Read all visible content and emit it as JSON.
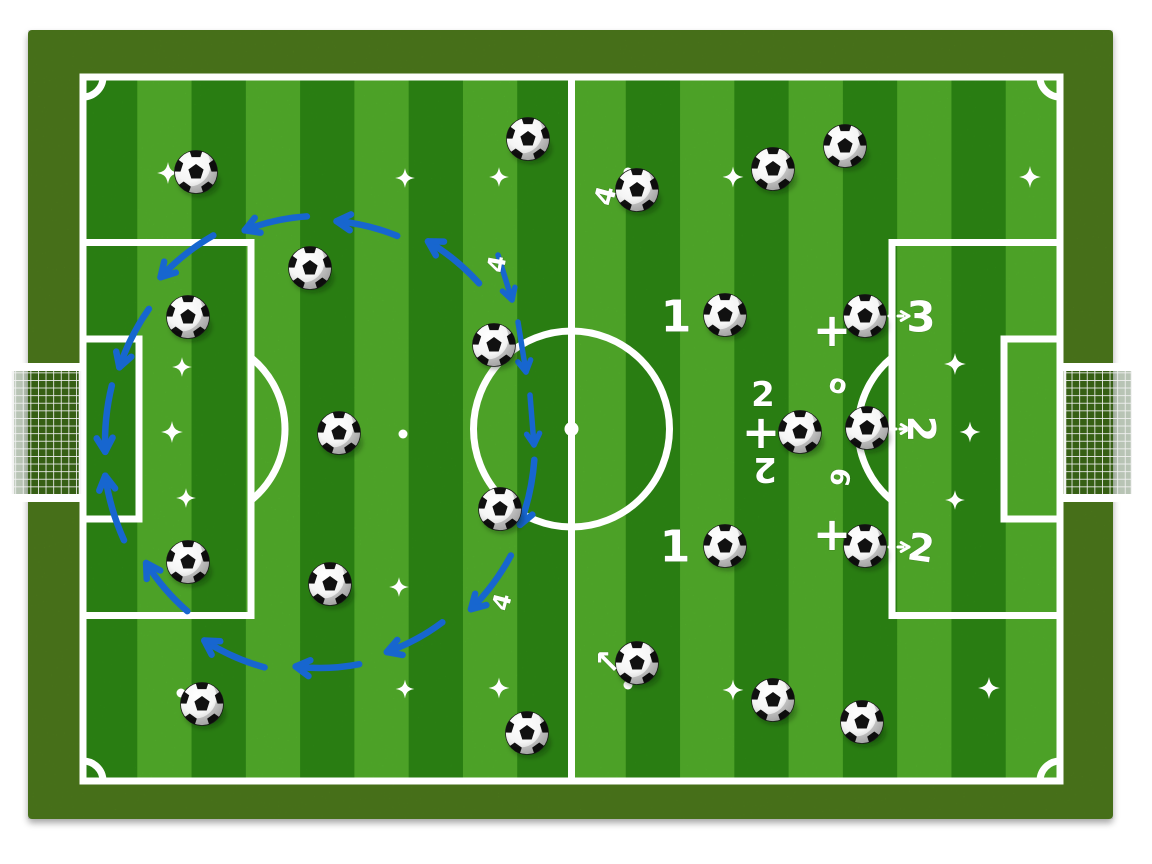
{
  "scene": {
    "description": "Soccer training drill diagram: striped football pitch viewed from above with scattered balls, white sparkle markers, hand-drawn white number annotations and a blue hand-drawn dashed circular arrow flow on the left half",
    "background_color": "#ffffff"
  },
  "field": {
    "border_color": "#507d1d",
    "stripe_dark": "#2e8c15",
    "stripe_light": "#55b52c",
    "line_color": "#ffffff",
    "line_width": 7,
    "outer": {
      "x": 28,
      "y": 30,
      "w": 1085,
      "h": 789
    },
    "pitch": {
      "x": 83,
      "y": 77,
      "w": 977,
      "h": 704
    },
    "stripe_count": 18,
    "first_stripe_dark": true,
    "center_circle_radius": 98,
    "center_dot_radius": 7,
    "penalty_box": {
      "w": 168,
      "h": 373
    },
    "goal_box": {
      "w": 56,
      "h": 180
    },
    "penalty_spot_dist": 110,
    "penalty_arc_radius": 92,
    "corner_arc_radius": 20,
    "goal": {
      "depth": 75,
      "mouth_top": 363,
      "mouth_bottom": 500
    }
  },
  "balls": [
    {
      "x": 528,
      "y": 139
    },
    {
      "x": 845,
      "y": 146
    },
    {
      "x": 773,
      "y": 169
    },
    {
      "x": 637,
      "y": 190
    },
    {
      "x": 196,
      "y": 172
    },
    {
      "x": 310,
      "y": 268
    },
    {
      "x": 188,
      "y": 317
    },
    {
      "x": 494,
      "y": 345
    },
    {
      "x": 725,
      "y": 315
    },
    {
      "x": 865,
      "y": 316
    },
    {
      "x": 339,
      "y": 433
    },
    {
      "x": 800,
      "y": 432
    },
    {
      "x": 867,
      "y": 428
    },
    {
      "x": 188,
      "y": 562
    },
    {
      "x": 330,
      "y": 584
    },
    {
      "x": 500,
      "y": 509
    },
    {
      "x": 202,
      "y": 704
    },
    {
      "x": 527,
      "y": 733
    },
    {
      "x": 725,
      "y": 546
    },
    {
      "x": 865,
      "y": 546
    },
    {
      "x": 637,
      "y": 663
    },
    {
      "x": 773,
      "y": 700
    },
    {
      "x": 862,
      "y": 722
    }
  ],
  "sparkles": [
    {
      "x": 168,
      "y": 173,
      "s": 1.0
    },
    {
      "x": 405,
      "y": 178,
      "s": 0.9
    },
    {
      "x": 499,
      "y": 177,
      "s": 0.9
    },
    {
      "x": 733,
      "y": 177,
      "s": 0.95
    },
    {
      "x": 1030,
      "y": 177,
      "s": 1.0
    },
    {
      "x": 182,
      "y": 367,
      "s": 0.9
    },
    {
      "x": 955,
      "y": 364,
      "s": 1.0
    },
    {
      "x": 172,
      "y": 432,
      "s": 1.0
    },
    {
      "x": 970,
      "y": 432,
      "s": 0.95
    },
    {
      "x": 186,
      "y": 498,
      "s": 0.9
    },
    {
      "x": 955,
      "y": 500,
      "s": 0.9
    },
    {
      "x": 399,
      "y": 587,
      "s": 0.9
    },
    {
      "x": 405,
      "y": 689,
      "s": 0.85
    },
    {
      "x": 499,
      "y": 688,
      "s": 0.95
    },
    {
      "x": 733,
      "y": 690,
      "s": 0.95
    },
    {
      "x": 989,
      "y": 688,
      "s": 1.0
    }
  ],
  "small_marks": [
    {
      "x": 403,
      "y": 434
    },
    {
      "x": 628,
      "y": 685
    },
    {
      "x": 628,
      "y": 172
    },
    {
      "x": 181,
      "y": 693
    }
  ],
  "labels": [
    {
      "text": "1",
      "x": 676,
      "y": 317,
      "size": 44,
      "rot": 0
    },
    {
      "text": "1",
      "x": 675,
      "y": 547,
      "size": 44,
      "rot": 0
    },
    {
      "text": "2",
      "x": 763,
      "y": 395,
      "size": 34,
      "rot": 0
    },
    {
      "text": "+",
      "x": 761,
      "y": 432,
      "size": 46,
      "rot": 0
    },
    {
      "text": "2",
      "x": 765,
      "y": 469,
      "size": 34,
      "rot": 180
    },
    {
      "text": "+",
      "x": 832,
      "y": 330,
      "size": 46,
      "rot": 0
    },
    {
      "text": "+",
      "x": 832,
      "y": 534,
      "size": 46,
      "rot": 0
    },
    {
      "text": "3",
      "x": 921,
      "y": 317,
      "size": 42,
      "rot": 0
    },
    {
      "text": "2",
      "x": 921,
      "y": 429,
      "size": 38,
      "rot": 90
    },
    {
      "text": "2",
      "x": 921,
      "y": 548,
      "size": 38,
      "rot": 8
    },
    {
      "text": "4",
      "x": 606,
      "y": 196,
      "size": 27,
      "rot": -75
    },
    {
      "text": "4",
      "x": 497,
      "y": 264,
      "size": 24,
      "rot": -80
    },
    {
      "text": "4",
      "x": 502,
      "y": 602,
      "size": 24,
      "rot": -75
    },
    {
      "text": "o",
      "x": 838,
      "y": 385,
      "size": 26,
      "rot": 15
    },
    {
      "text": "6",
      "x": 839,
      "y": 477,
      "size": 26,
      "rot": 100
    },
    {
      "text": "↖",
      "x": 607,
      "y": 662,
      "size": 32,
      "rot": 0
    }
  ],
  "white_arrows": [
    {
      "x1": 889,
      "y1": 316,
      "x2": 909,
      "y2": 316
    },
    {
      "x1": 891,
      "y1": 429,
      "x2": 909,
      "y2": 429
    },
    {
      "x1": 889,
      "y1": 547,
      "x2": 909,
      "y2": 547
    }
  ],
  "blue_flow": {
    "color": "#1766cf",
    "stroke_width": 6.5,
    "center": {
      "x": 320,
      "y": 442
    },
    "rx": 215,
    "ry": 226,
    "span_deg": 17,
    "segments": [
      {
        "a": -52,
        "head": "start",
        "j": 1.02
      },
      {
        "a": -77,
        "head": "start",
        "j": 0.98
      },
      {
        "a": -102,
        "head": "start",
        "j": 1.0
      },
      {
        "a": -127,
        "head": "start",
        "j": 1.04
      },
      {
        "a": -152,
        "head": "start",
        "j": 0.99
      },
      {
        "a": -174,
        "head": "start",
        "j": 1.0
      },
      {
        "a": 163,
        "head": "end",
        "j": 1.01
      },
      {
        "a": 138,
        "head": "end",
        "j": 0.97
      },
      {
        "a": 113,
        "head": "end",
        "j": 1.03
      },
      {
        "a": 88,
        "head": "end",
        "j": 1.0
      },
      {
        "a": 63,
        "head": "end",
        "j": 0.98
      },
      {
        "a": 38,
        "head": "end",
        "j": 1.02
      },
      {
        "a": 13,
        "head": "end",
        "j": 1.0
      }
    ],
    "extra_strokes": [
      {
        "x1": 498,
        "y1": 255,
        "x2": 512,
        "y2": 300,
        "head": "end"
      },
      {
        "x1": 518,
        "y1": 322,
        "x2": 526,
        "y2": 372,
        "head": "end"
      },
      {
        "x1": 530,
        "y1": 395,
        "x2": 534,
        "y2": 445,
        "head": "end"
      }
    ]
  }
}
